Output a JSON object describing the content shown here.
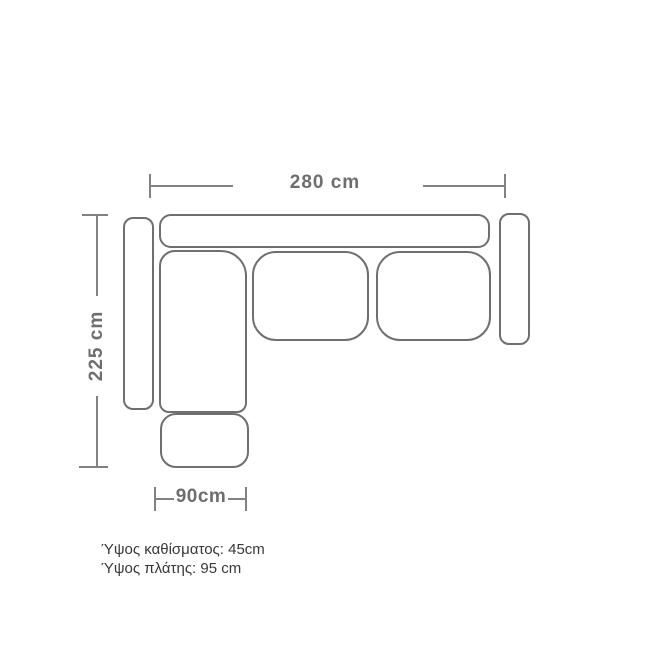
{
  "diagram": {
    "type": "sofa-top-view-dimension-drawing",
    "dimensions": {
      "total_width": "280 cm",
      "total_depth": "225 cm",
      "footstool_width": "90cm"
    },
    "notes": {
      "seat_height": "Ύψος καθίσματος: 45cm",
      "back_height": "Ύψος πλάτης: 95 cm"
    },
    "parts": [
      "back-cushion",
      "left-armrest",
      "right-armrest",
      "chaise-seat",
      "middle-seat-cushion",
      "right-seat-cushion",
      "footstool"
    ],
    "colors": {
      "outline": "#6f6f6f",
      "dimension_line": "#828282",
      "dimension_text": "#6e6e6e",
      "note_text": "#383838",
      "background": "#ffffff"
    }
  }
}
